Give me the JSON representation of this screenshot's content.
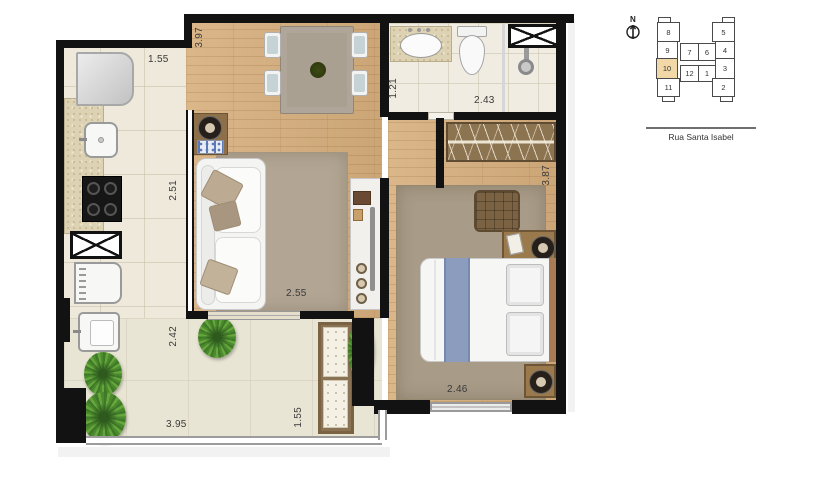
{
  "plan": {
    "dims": {
      "kitchen_width": "1.55",
      "living_length": "3.97",
      "bath_depth": "1.21",
      "bath_width": "2.43",
      "kitchen_depth": "2.51",
      "living_width": "2.55",
      "service_depth": "2.42",
      "bedroom_depth": "3.87",
      "bedroom_width": "2.46",
      "terrace_width": "3.95",
      "terrace_depth": "1.55"
    }
  },
  "keyplan": {
    "north_label": "N",
    "street_label": "Rua Santa Isabel",
    "highlighted_unit": "10",
    "units": [
      {
        "label": "8"
      },
      {
        "label": "5"
      },
      {
        "label": "9"
      },
      {
        "label": "7"
      },
      {
        "label": "6"
      },
      {
        "label": "4"
      },
      {
        "label": "10"
      },
      {
        "label": "12"
      },
      {
        "label": "1"
      },
      {
        "label": "3"
      },
      {
        "label": "11"
      },
      {
        "label": "2"
      }
    ]
  },
  "colors": {
    "wall": "#121212",
    "wood_floor": "#d6ae7c",
    "tile_floor": "#eee9da",
    "plant_green": "#4c8a2e",
    "unit_highlight": "#f2d7a7"
  }
}
